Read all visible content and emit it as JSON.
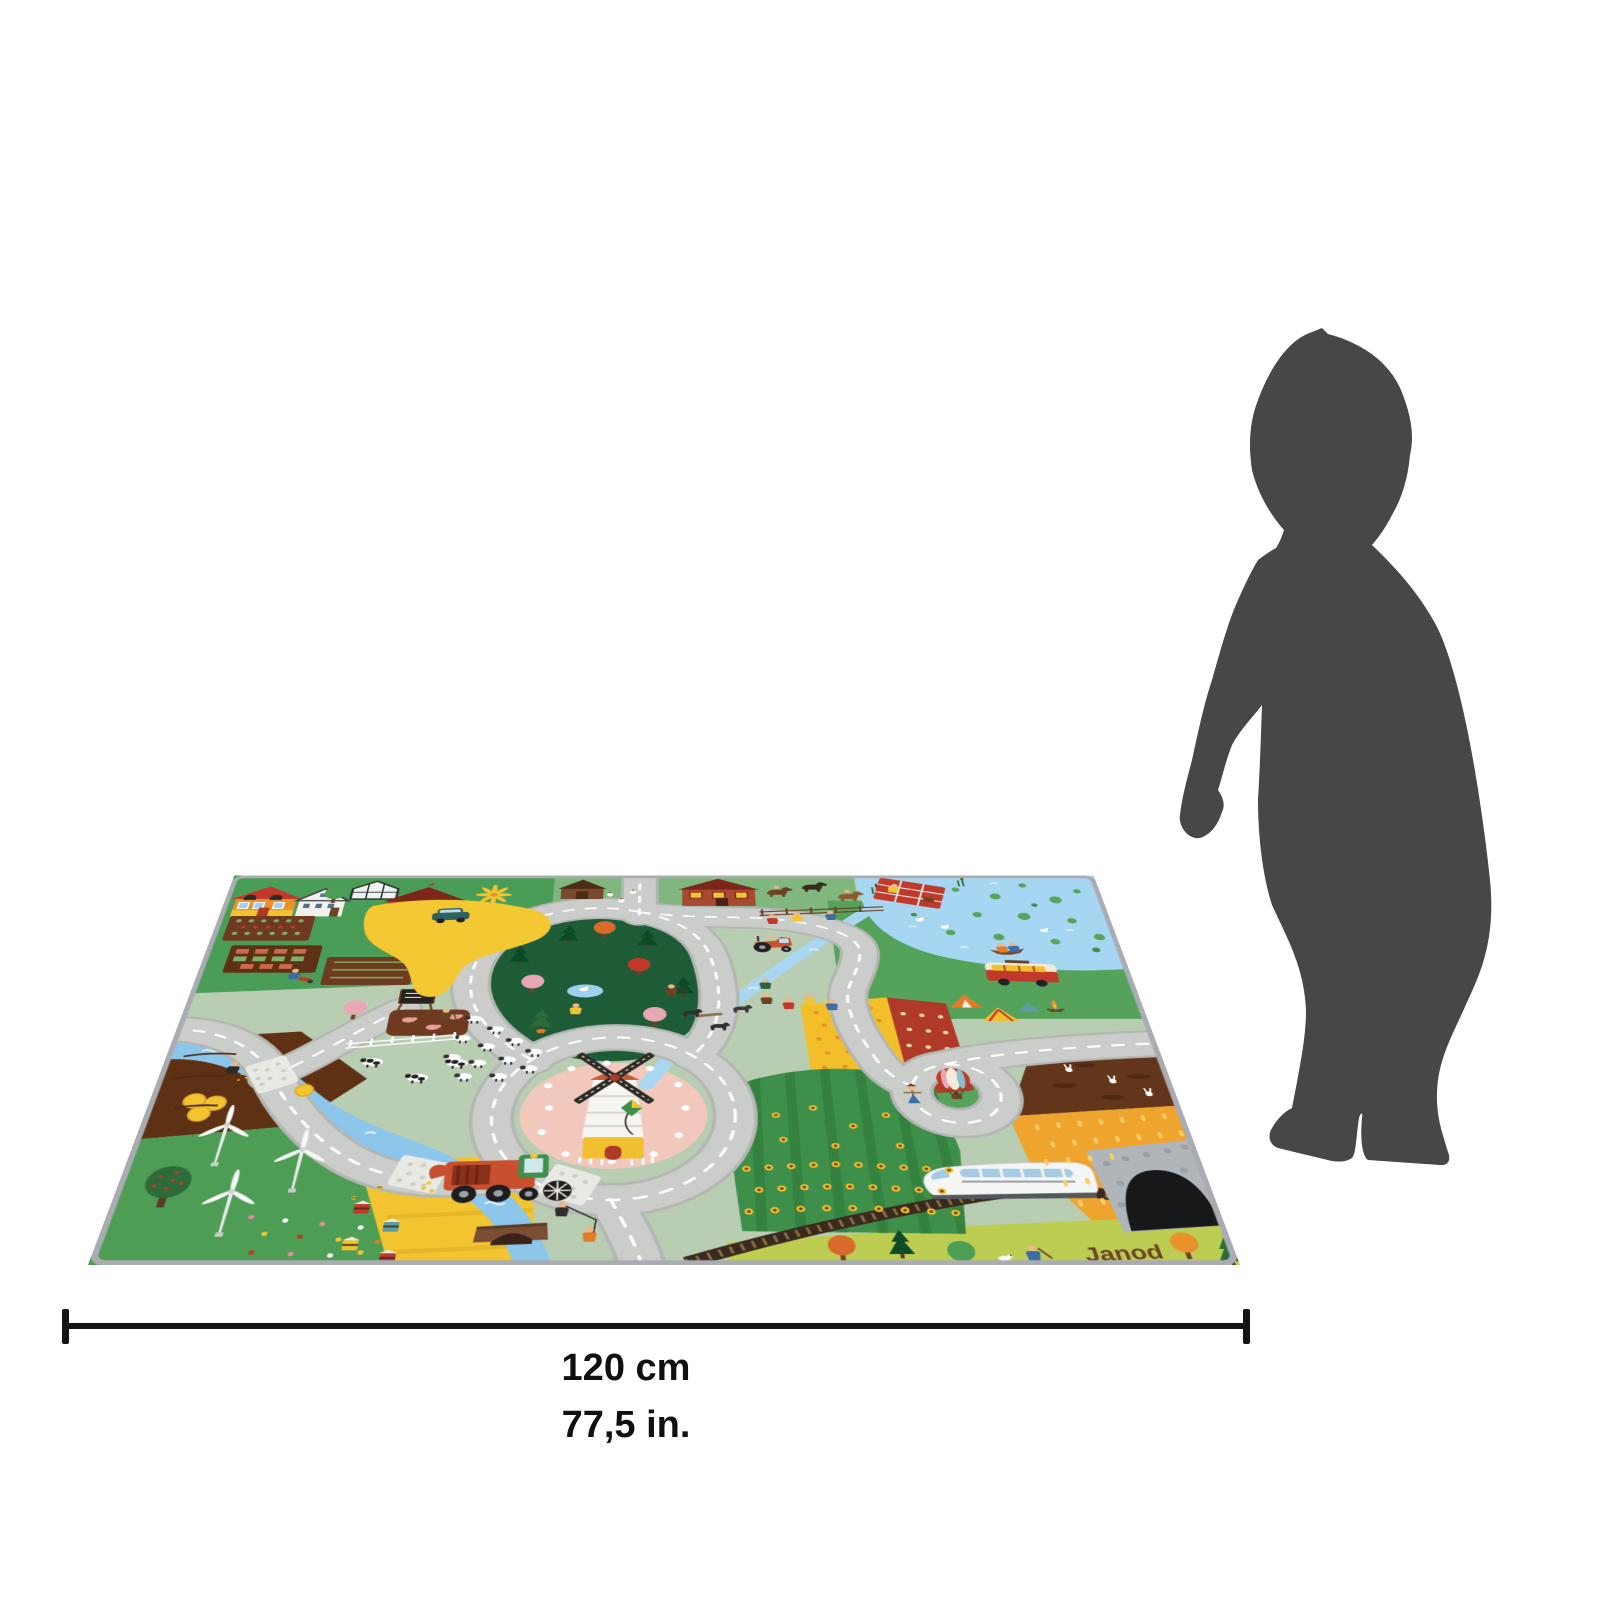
{
  "page": {
    "background": "#ffffff"
  },
  "product": {
    "brand_logo": "Janod",
    "item": "farm village road play rug"
  },
  "dimensions": {
    "label_cm": "120 cm",
    "label_in": "77,5 in."
  },
  "scale_figure": {
    "name": "child silhouette",
    "color": "#474747"
  },
  "mat": {
    "border_color": "#a9adb3",
    "road_color": "#cbcdca",
    "road_dash_color": "#ffffff",
    "base_green": "#b9cdb2",
    "grass_green": "#4a9d56",
    "forest_green": "#1d5c37",
    "water_blue": "#8cc6ea",
    "lake_blue": "#a6d6f2",
    "field_yellow": "#f2c430",
    "wheat_orange": "#efa42d",
    "soil_brown": "#5e3014",
    "windmill_hill_pink": "#f2c8bd",
    "barn_red": "#b5402a",
    "features": [
      "houses",
      "vegetable gardens",
      "greenhouse",
      "barn",
      "pinwheel",
      "farm courtyard",
      "car",
      "forest",
      "pond",
      "sheep",
      "shepherd",
      "cows",
      "picket fence",
      "pigs",
      "chalkboard",
      "river",
      "stone bridges",
      "arched bridge",
      "windmill",
      "horses",
      "riders",
      "tractor",
      "goats",
      "hikers",
      "orchard",
      "sunflower field",
      "scarecrow",
      "hot-air balloon",
      "lake",
      "lily pads",
      "ducks",
      "rowing boat",
      "picnic blanket",
      "camper van",
      "tents",
      "campfire",
      "rabbit field",
      "wheat field",
      "railway",
      "high-speed train",
      "tunnel",
      "wind turbines",
      "hay bales",
      "combine harvester",
      "apple tree",
      "flower meadow",
      "beehives",
      "bees",
      "boy fishing",
      "kite",
      "trees",
      "gardener",
      "dog"
    ]
  }
}
